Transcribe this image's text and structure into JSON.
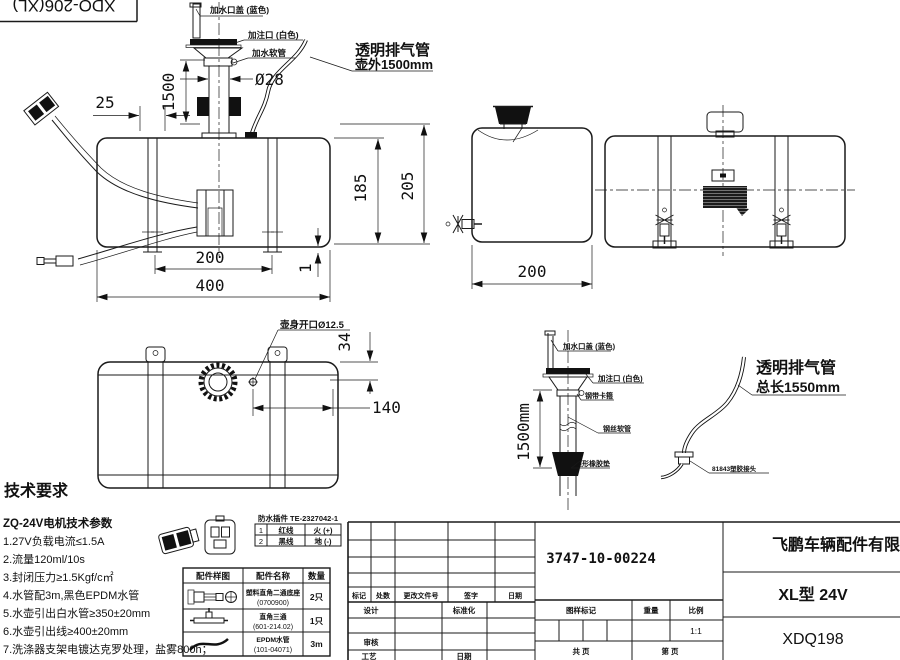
{
  "model_box": {
    "text": "XDQ-206(XL)"
  },
  "front_view": {
    "labels": {
      "cap_blue": "加水口盖 (蓝色)",
      "filler_white": "加注口 (白色)",
      "water_hose": "加水软管"
    },
    "vent": {
      "line1": "透明排气管",
      "line2": "壶外1500mm"
    },
    "dims": {
      "dia": "Ø28",
      "d25": "25",
      "d1500": "1500",
      "d185": "185",
      "d205": "205",
      "d200": "200",
      "d400": "400",
      "d1": "1"
    }
  },
  "side_view": {
    "dims": {
      "d200": "200"
    }
  },
  "top_view": {
    "label_opening": "壶身开口Ø12.5",
    "dims": {
      "d34": "34",
      "d140": "140"
    }
  },
  "filler_detail": {
    "labels": {
      "cap_blue": "加水口盖 (蓝色)",
      "filler_white": "加注口 (白色)",
      "clamp": "钢带卡箍",
      "wire_hose": "钢丝软管",
      "rubber_cone": "锥形橡胶垫"
    },
    "dim": "1500mm"
  },
  "vent_detail": {
    "line1": "透明排气管",
    "line2": "总长1550mm",
    "connector": "81843塑胶接头"
  },
  "tech_req": {
    "title": "技术要求",
    "subtitle": "ZQ-24V电机技术参数",
    "items": [
      "1.27V负载电流≤1.5A",
      "2.流量120ml/10s",
      "3.封闭压力≥1.5Kgf/c㎡",
      "4.水管配3m,黑色EPDM水管",
      "5.水壶引出白水管≥350±20mm",
      "6.水壶引出线≥400±20mm",
      "7.洗涤器支架电镀达克罗处理，盐雾800h；"
    ]
  },
  "pin_table": {
    "title": "防水插件 TE-2327042-1",
    "rows": [
      {
        "no": "1",
        "wire": "红线",
        "fn": "火 (+)"
      },
      {
        "no": "2",
        "wire": "黑线",
        "fn": "地 (-)"
      }
    ]
  },
  "parts_table": {
    "h_img": "配件样图",
    "h_name": "配件名称",
    "h_qty": "数量",
    "rows": [
      {
        "name": "塑料直角二通底座",
        "code": "(0700900)",
        "qty": "2只"
      },
      {
        "name": "直角三通",
        "code": "(601-214.02)",
        "qty": "1只"
      },
      {
        "name": "EPDM水管",
        "code": "(101-04071)",
        "qty": "3m"
      }
    ]
  },
  "title_block": {
    "part_number": "3747-10-00224",
    "company": "飞鹏车辆配件有限公",
    "product": "XL型 24V",
    "drawing_code": "XDQ198",
    "scale_value": "1:1",
    "labels": {
      "mark": "标记",
      "count": "处数",
      "change_doc": "更改文件号",
      "sign": "签字",
      "date": "日期",
      "design": "设计",
      "standard": "标准化",
      "check": "审核",
      "process": "工艺",
      "date2": "日期",
      "drawing_mark": "图样标记",
      "weight": "重量",
      "scale": "比例",
      "total_pages": "共  页",
      "page_no": "第  页"
    }
  }
}
